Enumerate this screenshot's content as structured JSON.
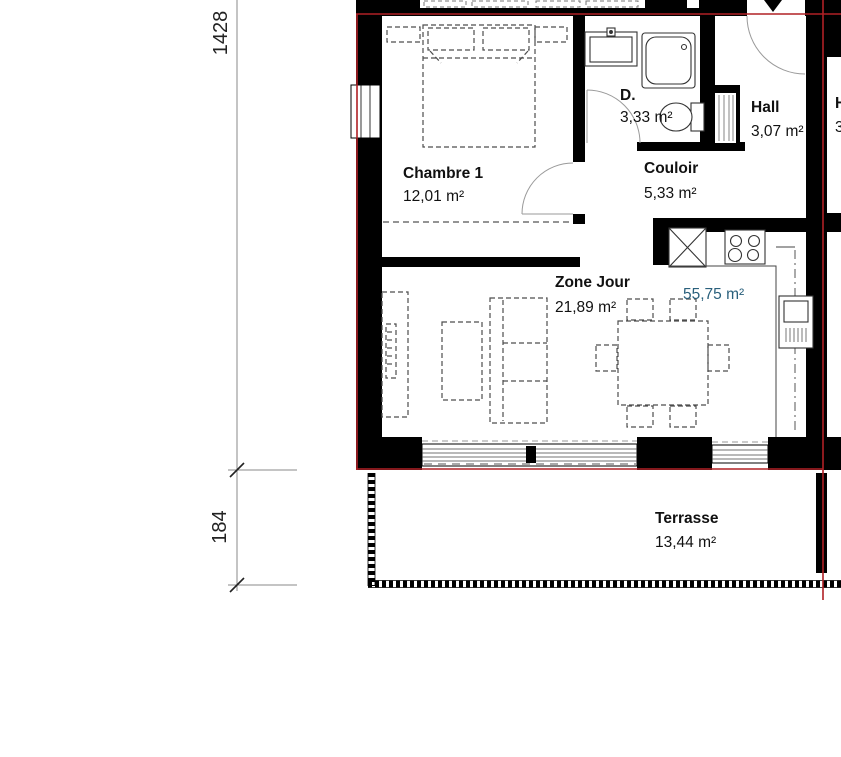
{
  "floor_plan": {
    "rooms": {
      "chambre1": {
        "name": "Chambre 1",
        "area": "12,01 m²"
      },
      "douche": {
        "name": "D.",
        "area": "3,33 m²"
      },
      "hall": {
        "name": "Hall",
        "area": "3,07 m²"
      },
      "couloir": {
        "name": "Couloir",
        "area": "5,33 m²"
      },
      "zone_jour": {
        "name": "Zone Jour",
        "area": "21,89 m²"
      },
      "terrasse": {
        "name": "Terrasse",
        "area": "13,44 m²"
      }
    },
    "total_area": "55,75 m²",
    "dimensions": {
      "vertical_total": "1428",
      "terrace_depth": "184"
    },
    "adjacent_unit_fragment": {
      "name": "H",
      "area": "3"
    },
    "colors": {
      "apartment_boundary": "#b02025",
      "total_area_text": "#2a607c",
      "walls": "#000000"
    }
  }
}
